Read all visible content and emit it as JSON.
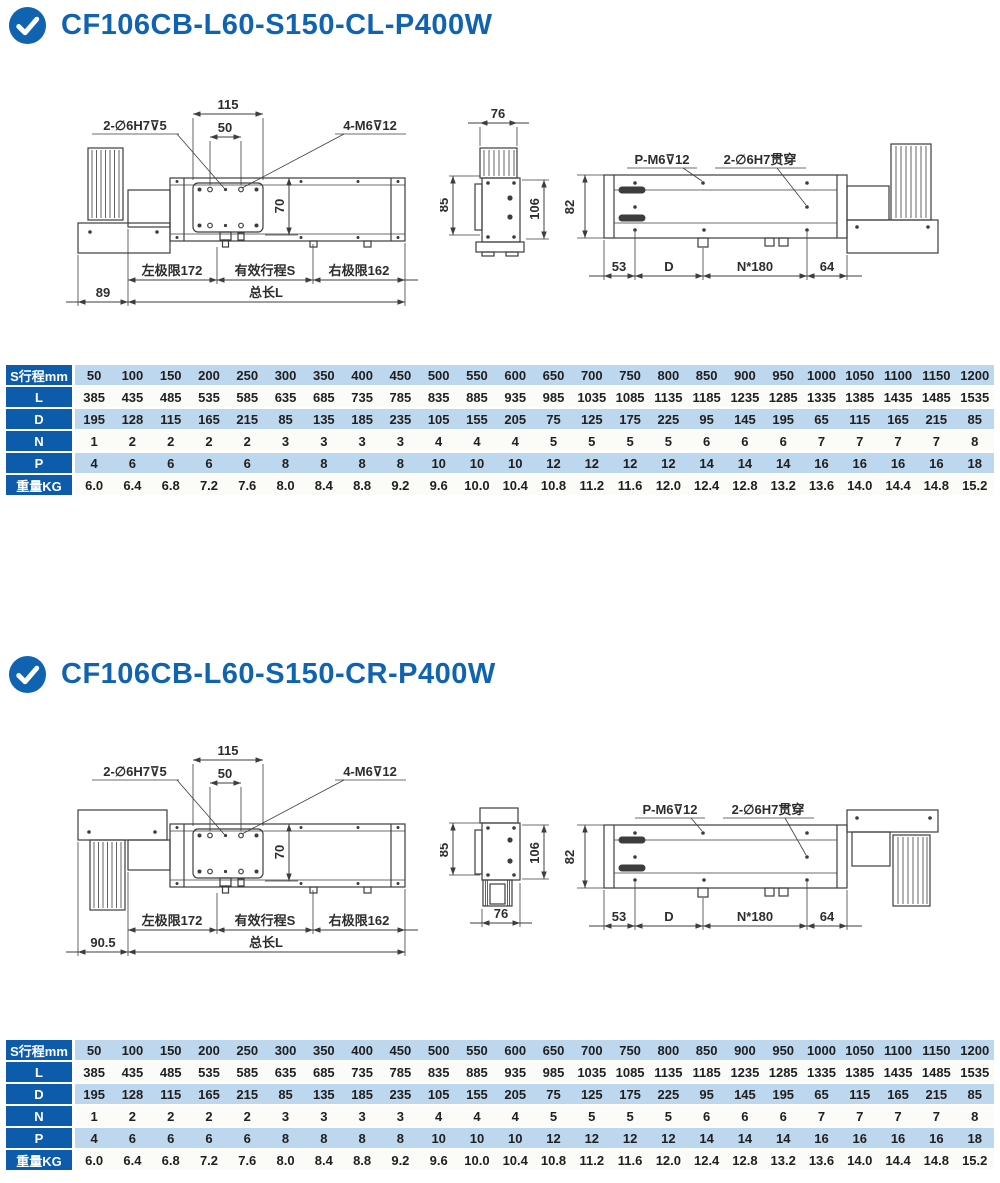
{
  "colors": {
    "accent": "#1063b0",
    "table_label_bg": "#0d5cab",
    "row_tint": "#bdd7ee",
    "row_plain": "#fbfbf8",
    "drawing_line": "#3d3d3d"
  },
  "sections": [
    {
      "title": "CF106CB-L60-S150-CL-P400W",
      "main_view": {
        "w115": "115",
        "w50": "50",
        "hole_label": "2-∅6H7⊽5",
        "thread_label": "4-M6⊽12",
        "h70": "70",
        "left_limit": "左极限172",
        "stroke_s": "有效行程S",
        "right_limit": "右极限162",
        "offset": "89",
        "total_len": "总长L"
      },
      "section_view": {
        "w76": "76",
        "h85": "85",
        "h106": "106"
      },
      "bottom_view": {
        "p_label": "P-M6⊽12",
        "through_label": "2-∅6H7贯穿",
        "h82": "82",
        "d53": "53",
        "dD": "D",
        "dN": "N*180",
        "d64": "64"
      }
    },
    {
      "title": "CF106CB-L60-S150-CR-P400W",
      "main_view": {
        "w115": "115",
        "w50": "50",
        "hole_label": "2-∅6H7⊽5",
        "thread_label": "4-M6⊽12",
        "h70": "70",
        "left_limit": "左极限172",
        "stroke_s": "有效行程S",
        "right_limit": "右极限162",
        "offset": "90.5",
        "total_len": "总长L"
      },
      "section_view": {
        "w76": "76",
        "h85": "85",
        "h106": "106"
      },
      "bottom_view": {
        "p_label": "P-M6⊽12",
        "through_label": "2-∅6H7贯穿",
        "h82": "82",
        "d53": "53",
        "dD": "D",
        "dN": "N*180",
        "d64": "64"
      }
    }
  ],
  "spec_table": {
    "rows": [
      {
        "label": "S行程mm",
        "values": [
          "50",
          "100",
          "150",
          "200",
          "250",
          "300",
          "350",
          "400",
          "450",
          "500",
          "550",
          "600",
          "650",
          "700",
          "750",
          "800",
          "850",
          "900",
          "950",
          "1000",
          "1050",
          "1100",
          "1150",
          "1200"
        ]
      },
      {
        "label": "L",
        "values": [
          "385",
          "435",
          "485",
          "535",
          "585",
          "635",
          "685",
          "735",
          "785",
          "835",
          "885",
          "935",
          "985",
          "1035",
          "1085",
          "1135",
          "1185",
          "1235",
          "1285",
          "1335",
          "1385",
          "1435",
          "1485",
          "1535"
        ]
      },
      {
        "label": "D",
        "values": [
          "195",
          "128",
          "115",
          "165",
          "215",
          "85",
          "135",
          "185",
          "235",
          "105",
          "155",
          "205",
          "75",
          "125",
          "175",
          "225",
          "95",
          "145",
          "195",
          "65",
          "115",
          "165",
          "215",
          "85"
        ]
      },
      {
        "label": "N",
        "values": [
          "1",
          "2",
          "2",
          "2",
          "2",
          "3",
          "3",
          "3",
          "3",
          "4",
          "4",
          "4",
          "5",
          "5",
          "5",
          "5",
          "6",
          "6",
          "6",
          "7",
          "7",
          "7",
          "7",
          "8"
        ]
      },
      {
        "label": "P",
        "values": [
          "4",
          "6",
          "6",
          "6",
          "6",
          "8",
          "8",
          "8",
          "8",
          "10",
          "10",
          "10",
          "12",
          "12",
          "12",
          "12",
          "14",
          "14",
          "14",
          "16",
          "16",
          "16",
          "16",
          "18"
        ]
      },
      {
        "label": "重量KG",
        "values": [
          "6.0",
          "6.4",
          "6.8",
          "7.2",
          "7.6",
          "8.0",
          "8.4",
          "8.8",
          "9.2",
          "9.6",
          "10.0",
          "10.4",
          "10.8",
          "11.2",
          "11.6",
          "12.0",
          "12.4",
          "12.8",
          "13.2",
          "13.6",
          "14.0",
          "14.4",
          "14.8",
          "15.2"
        ]
      }
    ]
  }
}
